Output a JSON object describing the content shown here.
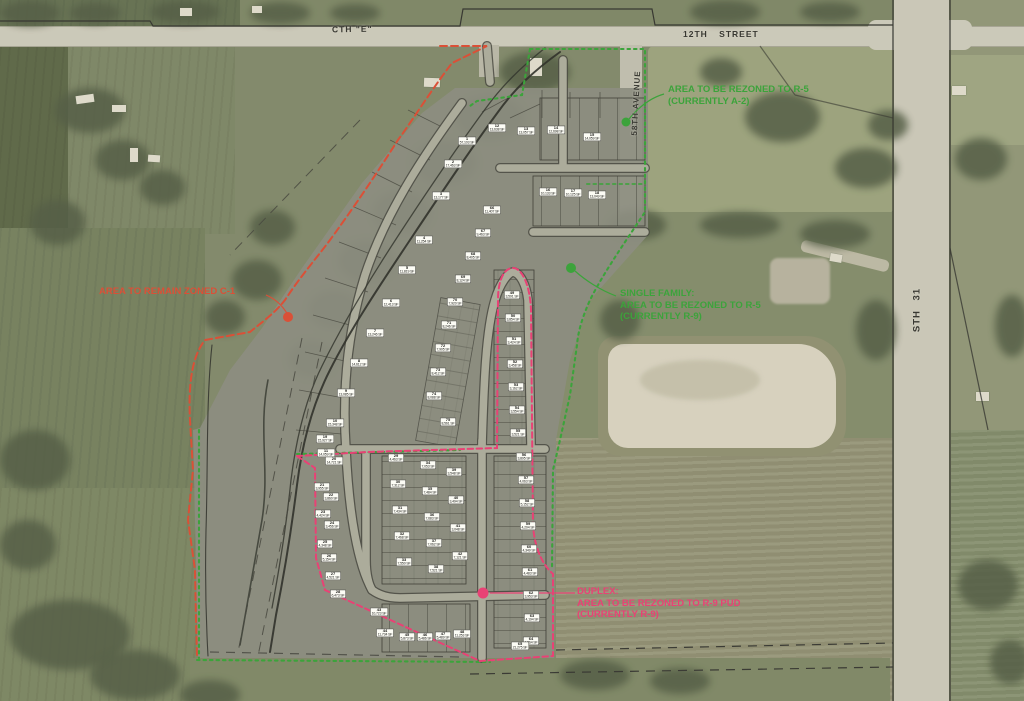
{
  "map": {
    "title": "Rezoning exhibit aerial site plan",
    "roads": {
      "cth_e": "CTH \"E\"",
      "twelfth_street": "12TH  STREET",
      "ave_58": "58TH  AVENUE",
      "sth_31": "STH  31"
    },
    "colors": {
      "rezone_green": "#2f9e2f",
      "remain_red": "#d9442b",
      "duplex_pink": "#e8356d"
    },
    "annotations": {
      "r5_north": {
        "zone": "rezone_green",
        "lines": [
          "AREA TO BE REZONED TO R-5",
          "(CURRENTLY A-2)"
        ]
      },
      "c1_west": {
        "zone": "remain_red",
        "lines": [
          "AREA TO REMAIN ZONED C-1"
        ]
      },
      "r5_single_family": {
        "zone": "rezone_green",
        "lines": [
          "SINGLE FAMILY:",
          "AREA TO BE REZONED TO R-5",
          "(CURRENTLY R-9)"
        ]
      },
      "r9_duplex": {
        "zone": "duplex_pink",
        "lines": [
          "DUPLEX:",
          "AREA TO BE REZONED TO R-9 PUD",
          "(CURRENTLY R-9)"
        ]
      }
    },
    "lots": [
      [
        467,
        141,
        "1",
        "57,103 SF"
      ],
      [
        453,
        164,
        "2",
        "17,463 SF"
      ],
      [
        441,
        196,
        "3",
        "13,177 SF"
      ],
      [
        424,
        240,
        "4",
        "11,254 SF"
      ],
      [
        407,
        270,
        "5",
        "11,819 SF"
      ],
      [
        391,
        303,
        "6",
        "12,413 SF"
      ],
      [
        375,
        333,
        "7",
        "13,246 SF"
      ],
      [
        359,
        363,
        "8",
        "14,612 SF"
      ],
      [
        346,
        393,
        "9",
        "13,085 SF"
      ],
      [
        335,
        423,
        "10",
        "15,348 SF"
      ],
      [
        326,
        453,
        "11",
        "14,059 SF"
      ],
      [
        497,
        128,
        "12",
        "13,638 SF"
      ],
      [
        526,
        131,
        "13",
        "13,057 SF"
      ],
      [
        556,
        130,
        "14",
        "12,698 SF"
      ],
      [
        592,
        137,
        "15",
        "14,059 SF"
      ],
      [
        548,
        192,
        "16",
        "10,133 SF"
      ],
      [
        573,
        193,
        "17",
        "10,125 SF"
      ],
      [
        597,
        195,
        "18",
        "13,049 SF"
      ],
      [
        325,
        439,
        "19",
        "15,927 SF"
      ],
      [
        334,
        461,
        "20",
        "14,721 SF"
      ],
      [
        322,
        487,
        "21",
        "3,955 SF"
      ],
      [
        331,
        497,
        "22",
        "3,860 SF"
      ],
      [
        323,
        514,
        "23",
        "4,424 SF"
      ],
      [
        332,
        525,
        "24",
        "3,456 SF"
      ],
      [
        325,
        544,
        "25",
        "4,348 SF"
      ],
      [
        329,
        558,
        "26",
        "5,154 SF"
      ],
      [
        333,
        576,
        "27",
        "4,521 SF"
      ],
      [
        338,
        594,
        "28",
        "6,473 SF"
      ],
      [
        396,
        458,
        "29",
        "4,463 SF"
      ],
      [
        398,
        484,
        "30",
        "7,312 SF"
      ],
      [
        400,
        510,
        "31",
        "7,434 SF"
      ],
      [
        402,
        536,
        "32",
        "7,468 SF"
      ],
      [
        404,
        562,
        "33",
        "7,550 SF"
      ],
      [
        428,
        465,
        "34",
        "7,053 SF"
      ],
      [
        430,
        491,
        "35",
        "7,484 SF"
      ],
      [
        432,
        517,
        "36",
        "7,683 SF"
      ],
      [
        434,
        543,
        "37",
        "7,062 SF"
      ],
      [
        436,
        569,
        "38",
        "7,521 SF"
      ],
      [
        454,
        472,
        "39",
        "3,548 SF"
      ],
      [
        456,
        500,
        "40",
        "3,494 SF"
      ],
      [
        458,
        528,
        "41",
        "3,048 SF"
      ],
      [
        460,
        556,
        "42",
        "7,121 SF"
      ],
      [
        379,
        612,
        "43",
        "10,723 SF"
      ],
      [
        385,
        633,
        "44",
        "11,734 SF"
      ],
      [
        407,
        637,
        "45",
        "5,873 SF"
      ],
      [
        425,
        637,
        "46",
        "5,486 SF"
      ],
      [
        443,
        636,
        "47",
        "5,489 SF"
      ],
      [
        462,
        634,
        "48",
        "11,253 SF"
      ],
      [
        512,
        295,
        "49",
        "3,591 SF"
      ],
      [
        513,
        318,
        "50",
        "3,854 SF"
      ],
      [
        514,
        341,
        "51",
        "3,424 SF"
      ],
      [
        515,
        364,
        "52",
        "3,458 SF"
      ],
      [
        516,
        387,
        "53",
        "3,162 SF"
      ],
      [
        517,
        410,
        "54",
        "3,554 SF"
      ],
      [
        518,
        433,
        "55",
        "3,521 SF"
      ],
      [
        524,
        457,
        "56",
        "3,895 SF"
      ],
      [
        526,
        480,
        "57",
        "4,063 SF"
      ],
      [
        527,
        503,
        "58",
        "5,152 SF"
      ],
      [
        528,
        526,
        "59",
        "4,204 SF"
      ],
      [
        529,
        549,
        "60",
        "4,349 SF"
      ],
      [
        530,
        572,
        "61",
        "4,483 SF"
      ],
      [
        531,
        595,
        "62",
        "3,953 SF"
      ],
      [
        532,
        618,
        "63",
        "4,194 SF"
      ],
      [
        531,
        641,
        "64",
        "4,564 SF"
      ],
      [
        520,
        646,
        "65",
        "21,275 SF"
      ],
      [
        492,
        210,
        "66",
        "11,407 SF"
      ],
      [
        483,
        233,
        "67",
        "9,463 SF"
      ],
      [
        473,
        256,
        "68",
        "8,405 SF"
      ],
      [
        463,
        279,
        "69",
        "8,124 SF"
      ],
      [
        455,
        302,
        "70",
        "7,920 SF"
      ],
      [
        449,
        325,
        "71",
        "8,246 SF"
      ],
      [
        443,
        348,
        "72",
        "7,905 SF"
      ],
      [
        438,
        372,
        "73",
        "8,412 SF"
      ],
      [
        434,
        396,
        "74",
        "8,088 SF"
      ],
      [
        448,
        422,
        "75",
        "8,561 SF"
      ]
    ]
  }
}
